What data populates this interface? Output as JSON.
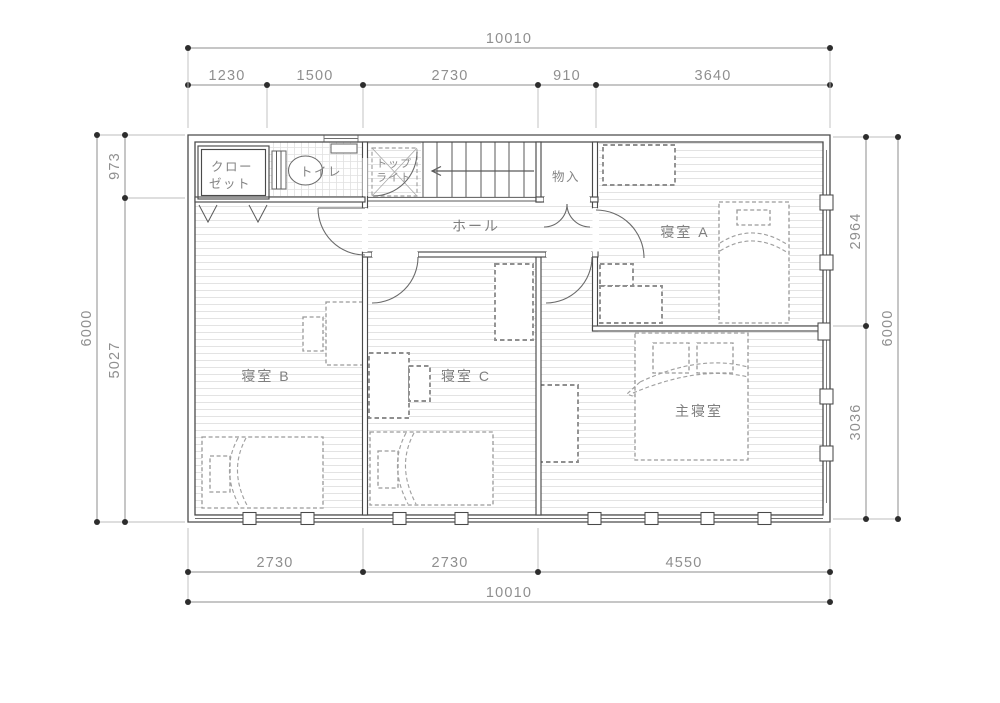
{
  "floor_plan": {
    "rooms": {
      "closet_line1": "クロー",
      "closet_line2": "ゼット",
      "toilet": "トイレ",
      "toplight_line1": "トップ",
      "toplight_line2": "ライト",
      "hall": "ホール",
      "storage": "物入",
      "bedroom_a": "寝室 A",
      "bedroom_b": "寝室 B",
      "bedroom_c": "寝室 C",
      "master_bedroom": "主寝室"
    },
    "dimensions_top": {
      "total": "10010",
      "segments": [
        "1230",
        "1500",
        "2730",
        "910",
        "3640"
      ]
    },
    "dimensions_bottom": {
      "total": "10010",
      "segments": [
        "2730",
        "2730",
        "4550"
      ]
    },
    "dimensions_left": {
      "total": "6000",
      "segments": [
        "973",
        "5027"
      ]
    },
    "dimensions_right": {
      "total": "6000",
      "segments": [
        "2964",
        "3036"
      ]
    },
    "colors": {
      "wall": "#4a4a4a",
      "dimension_text": "#8f8f8f",
      "room_text": "#7e7e7e",
      "floor_hatch": "#e3e3e3",
      "furniture_dash": "#9b9b9b"
    }
  }
}
